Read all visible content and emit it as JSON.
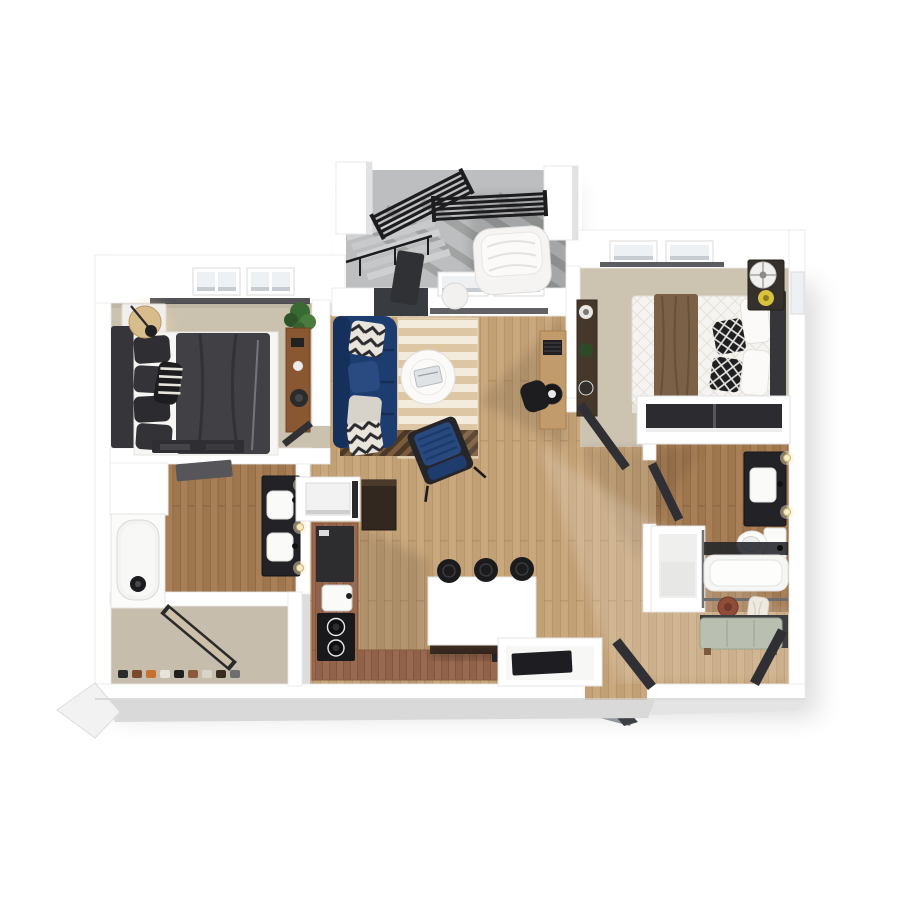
{
  "scene": {
    "type": "3d-floor-plan-render",
    "view": "top-down-dollhouse",
    "background": "#ffffff"
  },
  "colors": {
    "wall": "#ffffff",
    "wallEdge": "#e3e3e3",
    "skirt": "#d9d9d9",
    "carpet": "#cbc1af",
    "carpet2": "#cdc3b1",
    "closetCarpet": "#c7bdac",
    "woodLight": "#c9a87e",
    "woodLight2": "#c2a076",
    "woodLine": "#a9855e",
    "woodDark": "#a87f57",
    "woodDark2": "#9f774f",
    "woodDarkLine": "#7e5b3b",
    "counter": "#9a6a50",
    "counter2": "#91624a",
    "counterLine": "#6f4a36",
    "concrete": "#bcbebf",
    "railing": "#1d1d1f",
    "sofa": "#1d3c70",
    "sofaDark": "#16305c",
    "accentChair": "#27497e",
    "rugLight": "#f3ecdc",
    "rugDark": "#ddc6a3",
    "rugPatch": "#7a5c3d",
    "duvet": "#404045",
    "headboard": "#36363a",
    "bedWhite": "#f6f4f0",
    "throw": "#7b6147",
    "island": "#ffffff",
    "islandBase": "#3f2f24",
    "stool": "#1b1b1d",
    "appliance": "#19191b",
    "fridge": "#33281f",
    "vanity": "#232327",
    "fixture": "#fafaf9",
    "benchCushion": "#b9c0b2",
    "hat": "#8f4c36",
    "towel": "#efeae1",
    "lamp": "#d9bc8c",
    "plant": "#3a6a33",
    "doorDark": "#303034",
    "mat": "#1e1e22",
    "console1": "#8a5733",
    "dresser2": "#46372b",
    "desk": "#c29b6c",
    "nightstand2": "#35302b",
    "glass": "#22242a",
    "windowGlass": "#eef1f4",
    "sconce": "#f6ecc8"
  },
  "rooms": [
    {
      "name": "balcony",
      "items": [
        "pillar",
        "railing",
        "stair-railing",
        "stairs",
        "lounge-chair",
        "side-table",
        "open-balcony-door"
      ]
    },
    {
      "name": "living-room",
      "items": [
        "sofa",
        "chevron-pillows",
        "area-rug",
        "coffee-table",
        "accent-chair",
        "desk",
        "desk-chair",
        "windows"
      ]
    },
    {
      "name": "bedroom-1",
      "items": [
        "bed",
        "headboard",
        "pillows",
        "lamp",
        "nightstand",
        "plant",
        "console",
        "media-console",
        "windows",
        "door"
      ]
    },
    {
      "name": "bathroom-1",
      "items": [
        "bathtub",
        "double-vanity",
        "sinks",
        "sconces"
      ]
    },
    {
      "name": "walk-in-closet",
      "items": [
        "mirror-door",
        "shoes"
      ]
    },
    {
      "name": "laundry-closet",
      "items": [
        "washer"
      ]
    },
    {
      "name": "kitchen",
      "items": [
        "l-counter",
        "sink",
        "cooktop",
        "island",
        "bar-stools",
        "fridge-cabinet"
      ]
    },
    {
      "name": "entry",
      "items": [
        "door-mat",
        "entry-door",
        "niche"
      ]
    },
    {
      "name": "bedroom-2",
      "items": [
        "bed",
        "headboard",
        "throw-blanket",
        "diamond-pillows",
        "nightstand",
        "fan",
        "dresser",
        "closet-sliding-doors",
        "windows",
        "door"
      ]
    },
    {
      "name": "bathroom-2",
      "items": [
        "vanity",
        "sink",
        "toilet",
        "tub-with-glass",
        "shower-enclosure",
        "sconces",
        "door"
      ]
    },
    {
      "name": "mudroom-nook",
      "items": [
        "bench",
        "hook-rail",
        "hat",
        "towel"
      ]
    }
  ]
}
